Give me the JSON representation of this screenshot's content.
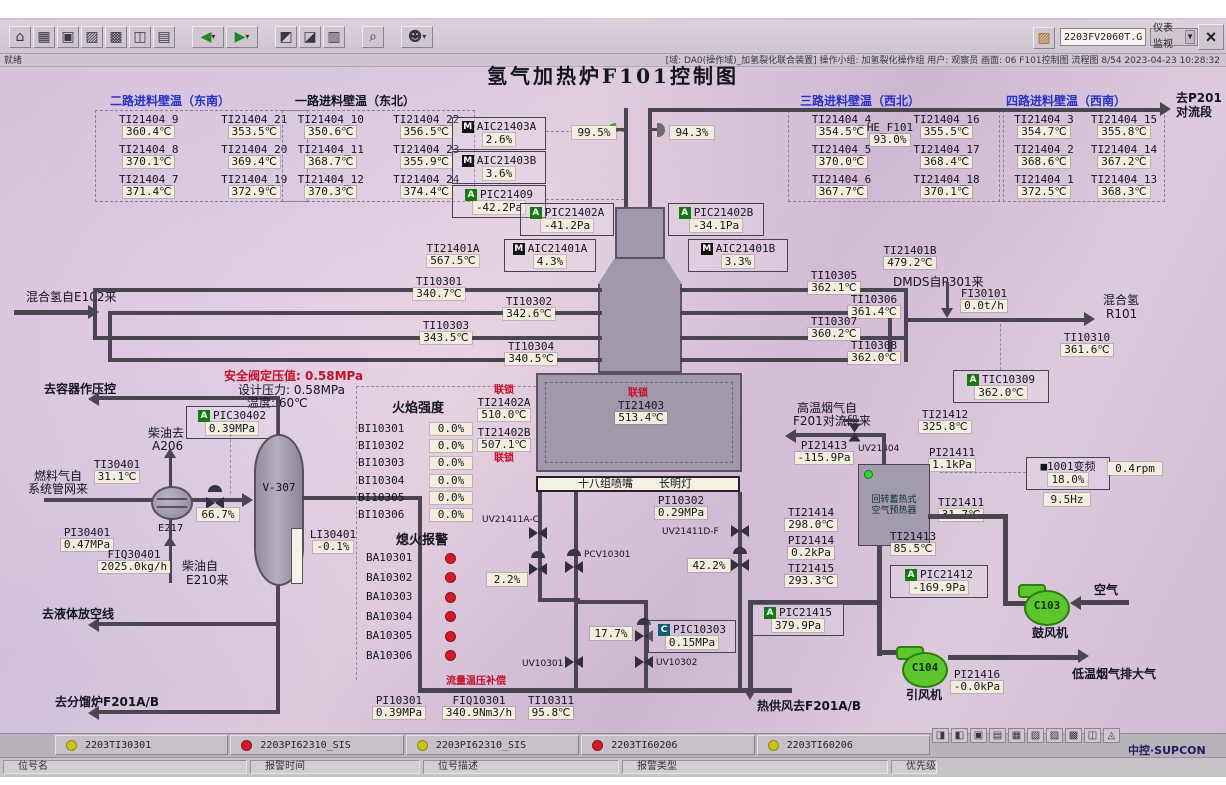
{
  "chrome": {
    "ready": "就绪",
    "filename": "2203FV2060T.GHT",
    "combo": "仪表监视",
    "status": "[域: DA0(操作域)_加氢裂化联合装置]  操作小组: 加氢裂化操作组  用户: 观察员  画面: 06 F101控制图  流程图 8/54  2023-04-23 10:28:32",
    "brand": "中控·SUPCON",
    "toolbar_icons": [
      {
        "n": "home-icon",
        "g": "⌂",
        "c": ""
      },
      {
        "n": "overview-icon",
        "g": "▦",
        "c": ""
      },
      {
        "n": "flowchart-icon",
        "g": "▣",
        "c": ""
      },
      {
        "n": "trend-icon",
        "g": "▨",
        "c": ""
      },
      {
        "n": "alarm-list-icon",
        "g": "▩",
        "c": ""
      },
      {
        "n": "faceplate-icon",
        "g": "◫",
        "c": ""
      },
      {
        "n": "report-icon",
        "g": "▤",
        "c": ""
      },
      {
        "n": "back-icon",
        "g": "◀",
        "c": "grn gap drop"
      },
      {
        "n": "forward-icon",
        "g": "▶",
        "c": "grn drop"
      },
      {
        "n": "prev-page-icon",
        "g": "◩",
        "c": "gap"
      },
      {
        "n": "next-page-icon",
        "g": "◪",
        "c": ""
      },
      {
        "n": "book-icon",
        "g": "▥",
        "c": ""
      },
      {
        "n": "search-icon",
        "g": "⌕",
        "c": "gap"
      },
      {
        "n": "user-icon",
        "g": "☻",
        "c": "gap drop"
      }
    ],
    "tray_icons": [
      {
        "n": "audio-icon",
        "g": "◨"
      },
      {
        "n": "lock-icon",
        "g": "◧"
      },
      {
        "n": "screen-icon",
        "g": "▣"
      },
      {
        "n": "printer-icon",
        "g": "▤"
      },
      {
        "n": "table-icon",
        "g": "▦"
      },
      {
        "n": "note-icon",
        "g": "▧"
      },
      {
        "n": "list-icon",
        "g": "▨"
      },
      {
        "n": "doc-icon",
        "g": "▩"
      },
      {
        "n": "grid-icon",
        "g": "◫"
      },
      {
        "n": "help-icon",
        "g": "◬"
      }
    ]
  },
  "title": "氢气加热炉F101控制图",
  "feed_tables": [
    {
      "title": "二路进料壁温（东南）",
      "cells": [
        {
          "tag": "TI21404_9",
          "val": "360.4℃"
        },
        {
          "tag": "TI21404_21",
          "val": "353.5℃"
        },
        {
          "tag": "TI21404_8",
          "val": "370.1℃"
        },
        {
          "tag": "TI21404_20",
          "val": "369.4℃"
        },
        {
          "tag": "TI21404_7",
          "val": "371.4℃"
        },
        {
          "tag": "TI21404_19",
          "val": "372.9℃"
        }
      ]
    },
    {
      "title": "一路进料壁温（东北）",
      "cells": [
        {
          "tag": "TI21404_10",
          "val": "350.6℃"
        },
        {
          "tag": "TI21404_22",
          "val": "356.5℃"
        },
        {
          "tag": "TI21404_11",
          "val": "368.7℃"
        },
        {
          "tag": "TI21404_23",
          "val": "355.9℃"
        },
        {
          "tag": "TI21404_12",
          "val": "370.3℃"
        },
        {
          "tag": "TI21404_24",
          "val": "374.4℃"
        }
      ]
    },
    {
      "title": "三路进料壁温（西北）",
      "cells": [
        {
          "tag": "TI21404_4",
          "val": "354.5℃"
        },
        {
          "tag": "TI21404_16",
          "val": "355.5℃"
        },
        {
          "tag": "TI21404_5",
          "val": "370.0℃"
        },
        {
          "tag": "TI21404_17",
          "val": "368.4℃"
        },
        {
          "tag": "TI21404_6",
          "val": "367.7℃"
        },
        {
          "tag": "TI21404_18",
          "val": "370.1℃"
        }
      ]
    },
    {
      "title": "四路进料壁温（西南）",
      "cells": [
        {
          "tag": "TI21404_3",
          "val": "354.7℃"
        },
        {
          "tag": "TI21404_15",
          "val": "355.8℃"
        },
        {
          "tag": "TI21404_2",
          "val": "368.6℃"
        },
        {
          "tag": "TI21404_14",
          "val": "367.2℃"
        },
        {
          "tag": "TI21404_1",
          "val": "372.5℃"
        },
        {
          "tag": "TI21404_13",
          "val": "368.3℃"
        }
      ]
    }
  ],
  "inst": {
    "AIC21403A": {
      "tag": "AIC21403A",
      "val": "2.6%",
      "badge": "M"
    },
    "AIC21403B": {
      "tag": "AIC21403B",
      "val": "3.6%",
      "badge": "M"
    },
    "PIC21409": {
      "tag": "PIC21409",
      "val": "-42.2Pa",
      "badge": "A"
    },
    "PIC21402A": {
      "tag": "PIC21402A",
      "val": "-41.2Pa",
      "badge": "A"
    },
    "PIC21402B": {
      "tag": "PIC21402B",
      "val": "-34.1Pa",
      "badge": "A"
    },
    "AIC21401A": {
      "tag": "AIC21401A",
      "val": "4.3%",
      "badge": "M"
    },
    "AIC21401B": {
      "tag": "AIC21401B",
      "val": "3.3%",
      "badge": "M"
    },
    "HE_F101": {
      "tag": "HE_F101",
      "val": "93.0%"
    },
    "TI21401A": {
      "tag": "TI21401A",
      "val": "567.5℃"
    },
    "TI21401B": {
      "tag": "TI21401B",
      "val": "479.2℃"
    },
    "TI10301": {
      "tag": "TI10301",
      "val": "340.7℃"
    },
    "TI10302": {
      "tag": "TI10302",
      "val": "342.6℃"
    },
    "TI10303": {
      "tag": "TI10303",
      "val": "343.5℃"
    },
    "TI10304": {
      "tag": "TI10304",
      "val": "340.5℃"
    },
    "TI10305": {
      "tag": "TI10305",
      "val": "362.1℃"
    },
    "TI10306": {
      "tag": "TI10306",
      "val": "361.4℃"
    },
    "TI10307": {
      "tag": "TI10307",
      "val": "360.2℃"
    },
    "TI10308": {
      "tag": "TI10308",
      "val": "362.0℃"
    },
    "FI30101": {
      "tag": "FI30101",
      "val": "0.0t/h"
    },
    "TI10310": {
      "tag": "TI10310",
      "val": "361.6℃"
    },
    "TIC10309": {
      "tag": "TIC10309",
      "val": "362.0℃",
      "badge": "A"
    },
    "TI21402A": {
      "tag": "TI21402A",
      "val": "510.0℃"
    },
    "TI21402B": {
      "tag": "TI21402B",
      "val": "507.1℃"
    },
    "TI21403": {
      "tag": "TI21403",
      "val": "513.4℃"
    },
    "PI10302": {
      "tag": "PI10302",
      "val": "0.29MPa"
    },
    "PIC10303": {
      "tag": "PIC10303",
      "val": "0.15MPa",
      "badge": "C"
    },
    "PI10301": {
      "tag": "PI10301",
      "val": "0.39MPa"
    },
    "FIQ10301": {
      "tag": "FIQ10301",
      "val": "340.9Nm3/h"
    },
    "TI10311": {
      "tag": "TI10311",
      "val": "95.8℃"
    },
    "PIC30402": {
      "tag": "PIC30402",
      "val": "0.39MPa",
      "badge": "A"
    },
    "TI30401": {
      "tag": "TI30401",
      "val": "31.1℃"
    },
    "PI30401": {
      "tag": "PI30401",
      "val": "0.47MPa"
    },
    "FIQ30401": {
      "tag": "FIQ30401",
      "val": "2025.0kg/h"
    },
    "LI30401": {
      "tag": "LI30401",
      "val": "-0.1%"
    },
    "TI21412": {
      "tag": "TI21412",
      "val": "325.8℃"
    },
    "PI21413": {
      "tag": "PI21413",
      "val": "-115.9Pa"
    },
    "PI21411": {
      "tag": "PI21411",
      "val": "1.1kPa"
    },
    "TI21411": {
      "tag": "TI21411",
      "val": "31.7℃"
    },
    "TI21413": {
      "tag": "TI21413",
      "val": "85.5℃"
    },
    "TI21414": {
      "tag": "TI21414",
      "val": "298.0℃"
    },
    "PI21414": {
      "tag": "PI21414",
      "val": "0.2kPa"
    },
    "TI21415": {
      "tag": "TI21415",
      "val": "293.3℃"
    },
    "PIC21412": {
      "tag": "PIC21412",
      "val": "-169.9Pa",
      "badge": "A"
    },
    "PIC21415": {
      "tag": "PIC21415",
      "val": "379.9Pa",
      "badge": "A"
    },
    "PI21416": {
      "tag": "PI21416",
      "val": "-0.0kPa"
    }
  },
  "valves": {
    "v99": "99.5%",
    "v94": "94.3%",
    "v66": "66.7%",
    "v22": "2.2%",
    "v42": "42.2%",
    "v17": "17.7%",
    "uvac": "UV21411A-C",
    "uvdf": "UV21411D-F",
    "pcv": "PCV10301",
    "uv1": "UV10301",
    "uv2": "UV10302",
    "uv4": "UV21404"
  },
  "vfd": {
    "name": "■1001变频",
    "pct": "18.0%",
    "hz": "9.5Hz",
    "rpm": "0.4rpm"
  },
  "flame": {
    "title": "火焰强度",
    "rows": [
      {
        "tag": "BI10301",
        "val": "0.0%"
      },
      {
        "tag": "BI10302",
        "val": "0.0%"
      },
      {
        "tag": "BI10303",
        "val": "0.0%"
      },
      {
        "tag": "BI10304",
        "val": "0.0%"
      },
      {
        "tag": "BI10305",
        "val": "0.0%"
      },
      {
        "tag": "BI10306",
        "val": "0.0%"
      }
    ]
  },
  "flameout": {
    "title": "熄火报警",
    "rows": [
      {
        "tag": "BA10301"
      },
      {
        "tag": "BA10302"
      },
      {
        "tag": "BA10303"
      },
      {
        "tag": "BA10304"
      },
      {
        "tag": "BA10305"
      },
      {
        "tag": "BA10306"
      }
    ]
  },
  "lbl": {
    "to_p201_1": "去P201",
    "to_p201_2": "对流段",
    "h2_in": "混合氢自E102来",
    "dmds": "DMDS自P301来",
    "h2_out_1": "混合氢",
    "h2_out_2": "R101",
    "to_vessel": "去容器作压控",
    "safety1": "安全阀定压值: 0.58MPa",
    "safety2": "设计压力: 0.58MPa",
    "safety3": "温度: 60℃",
    "diesel_to_1": "柴油去",
    "diesel_to_2": "A206",
    "fuel_1": "燃料气自",
    "fuel_2": "系统管网来",
    "e217": "E217",
    "v307": "V-307",
    "diesel_from_1": "柴油自",
    "diesel_from_2": "E210来",
    "to_flare": "去液体放空线",
    "to_f201": "去分馏炉F201A/B",
    "interlock": "联锁",
    "burner1": "十八组喷嘴",
    "burner2": "长明灯",
    "comp": "流量温压补偿",
    "hot_air": "热供风去F201A/B",
    "hot_flue_1": "高温烟气自",
    "hot_flue_2": "F201对流段来",
    "preheat_1": "回转蓄热式",
    "preheat_2": "空气预热器",
    "air": "空气",
    "c103": "C103",
    "c103n": "鼓风机",
    "c104": "C104",
    "c104n": "引风机",
    "cold_flue": "低温烟气排大气"
  },
  "alarms": {
    "cells": [
      {
        "color": "yellow",
        "tag": "2203TI30301"
      },
      {
        "color": "red",
        "tag": "2203PI62310_SIS"
      },
      {
        "color": "yellow",
        "tag": "2203PI62310_SIS"
      },
      {
        "color": "red",
        "tag": "2203TI60206"
      },
      {
        "color": "yellow",
        "tag": "2203TI60206"
      }
    ],
    "fields": [
      "位号名",
      "报警时间",
      "位号描述",
      "报警类型",
      "优先级"
    ]
  }
}
